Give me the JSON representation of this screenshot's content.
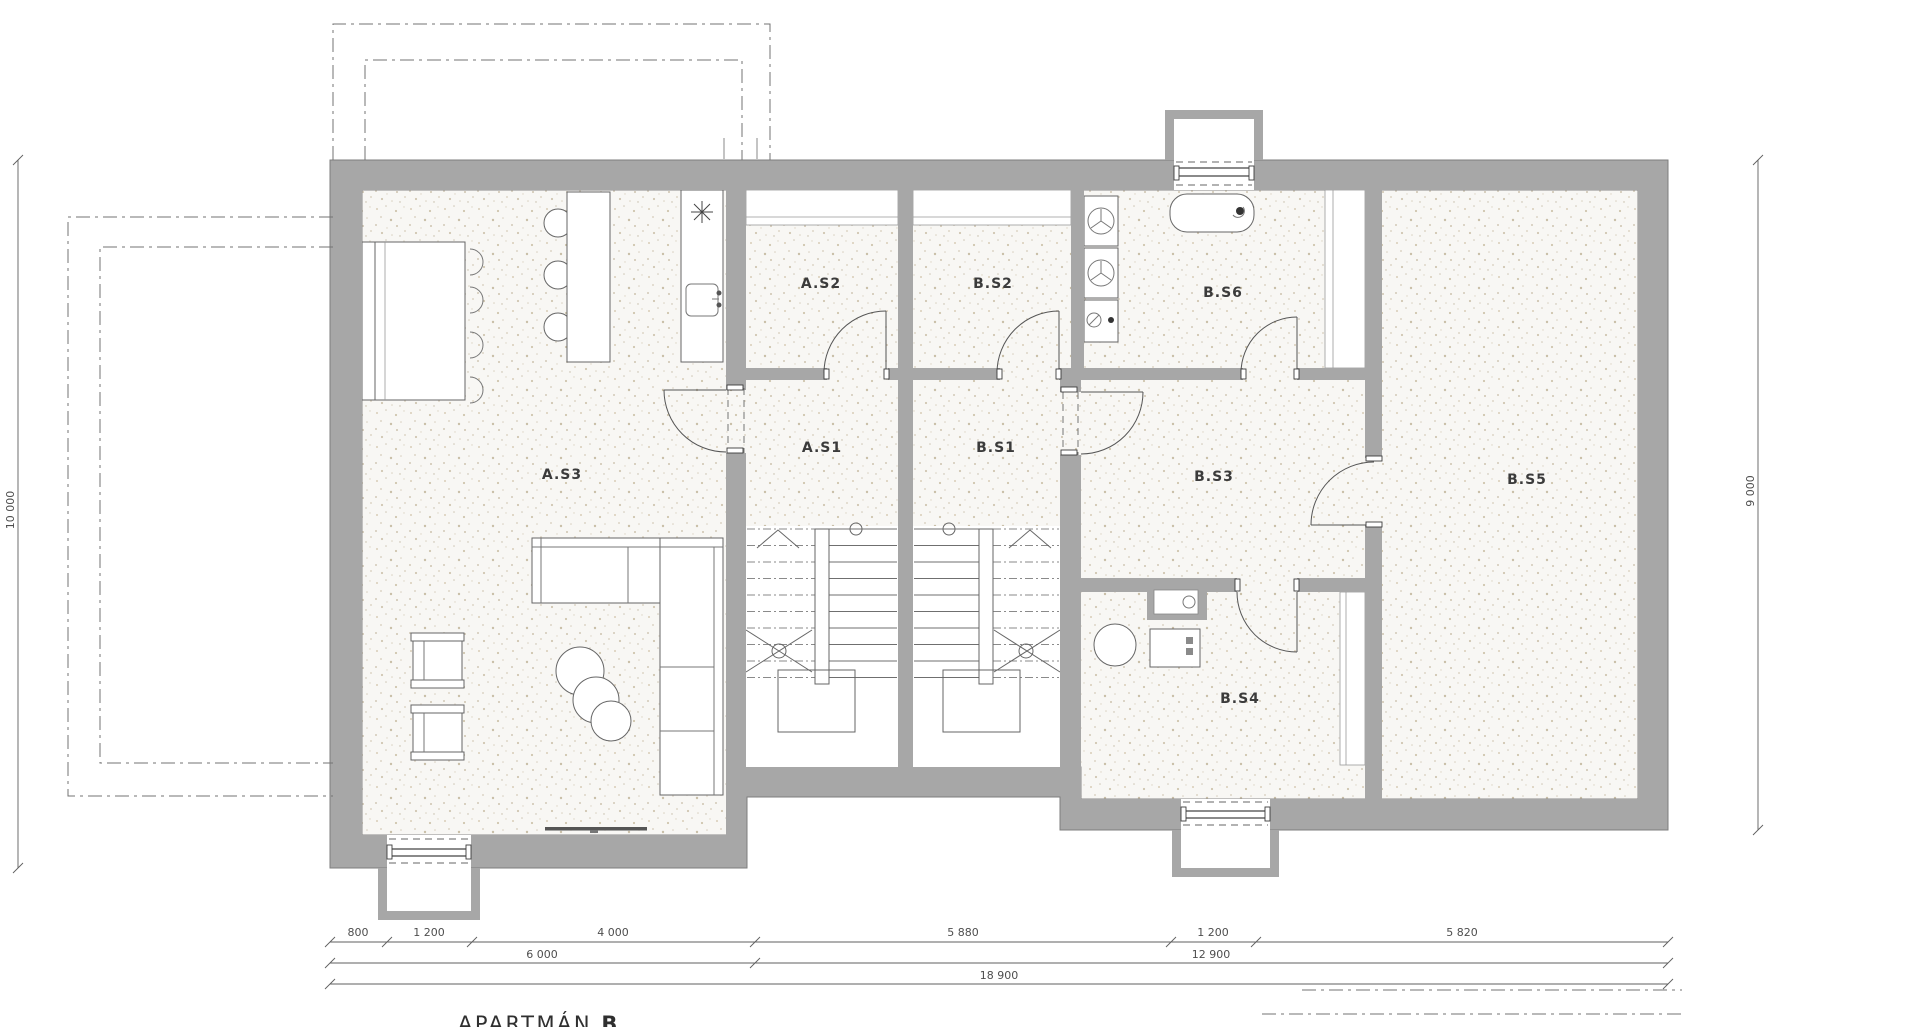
{
  "title": {
    "prefix": "APARTMÁN ",
    "bold": "B"
  },
  "rooms": {
    "as1": "A.S1",
    "as2": "A.S2",
    "as3": "A.S3",
    "bs1": "B.S1",
    "bs2": "B.S2",
    "bs3": "B.S3",
    "bs4": "B.S4",
    "bs5": "B.S5",
    "bs6": "B.S6"
  },
  "dims": {
    "d800": "800",
    "d1200a": "1 200",
    "d4000": "4 000",
    "d5880": "5 880",
    "d1200b": "1 200",
    "d5820": "5 820",
    "d6000": "6 000",
    "d12900": "12 900",
    "d18900": "18 900",
    "left": "10 000",
    "right": "9 000"
  },
  "colors": {
    "wall": "#a7a7a7",
    "floor_base": "#f8f7f4",
    "line": "#5f5f5f"
  },
  "legend": {
    "symbols": [
      "stair-icon",
      "bathtub-icon",
      "washing-machine-icon",
      "sink-icon",
      "cooktop-icon",
      "sofa-icon",
      "armchair-icon",
      "dining-table-icon",
      "kitchen-island-icon",
      "window-well-icon"
    ]
  }
}
